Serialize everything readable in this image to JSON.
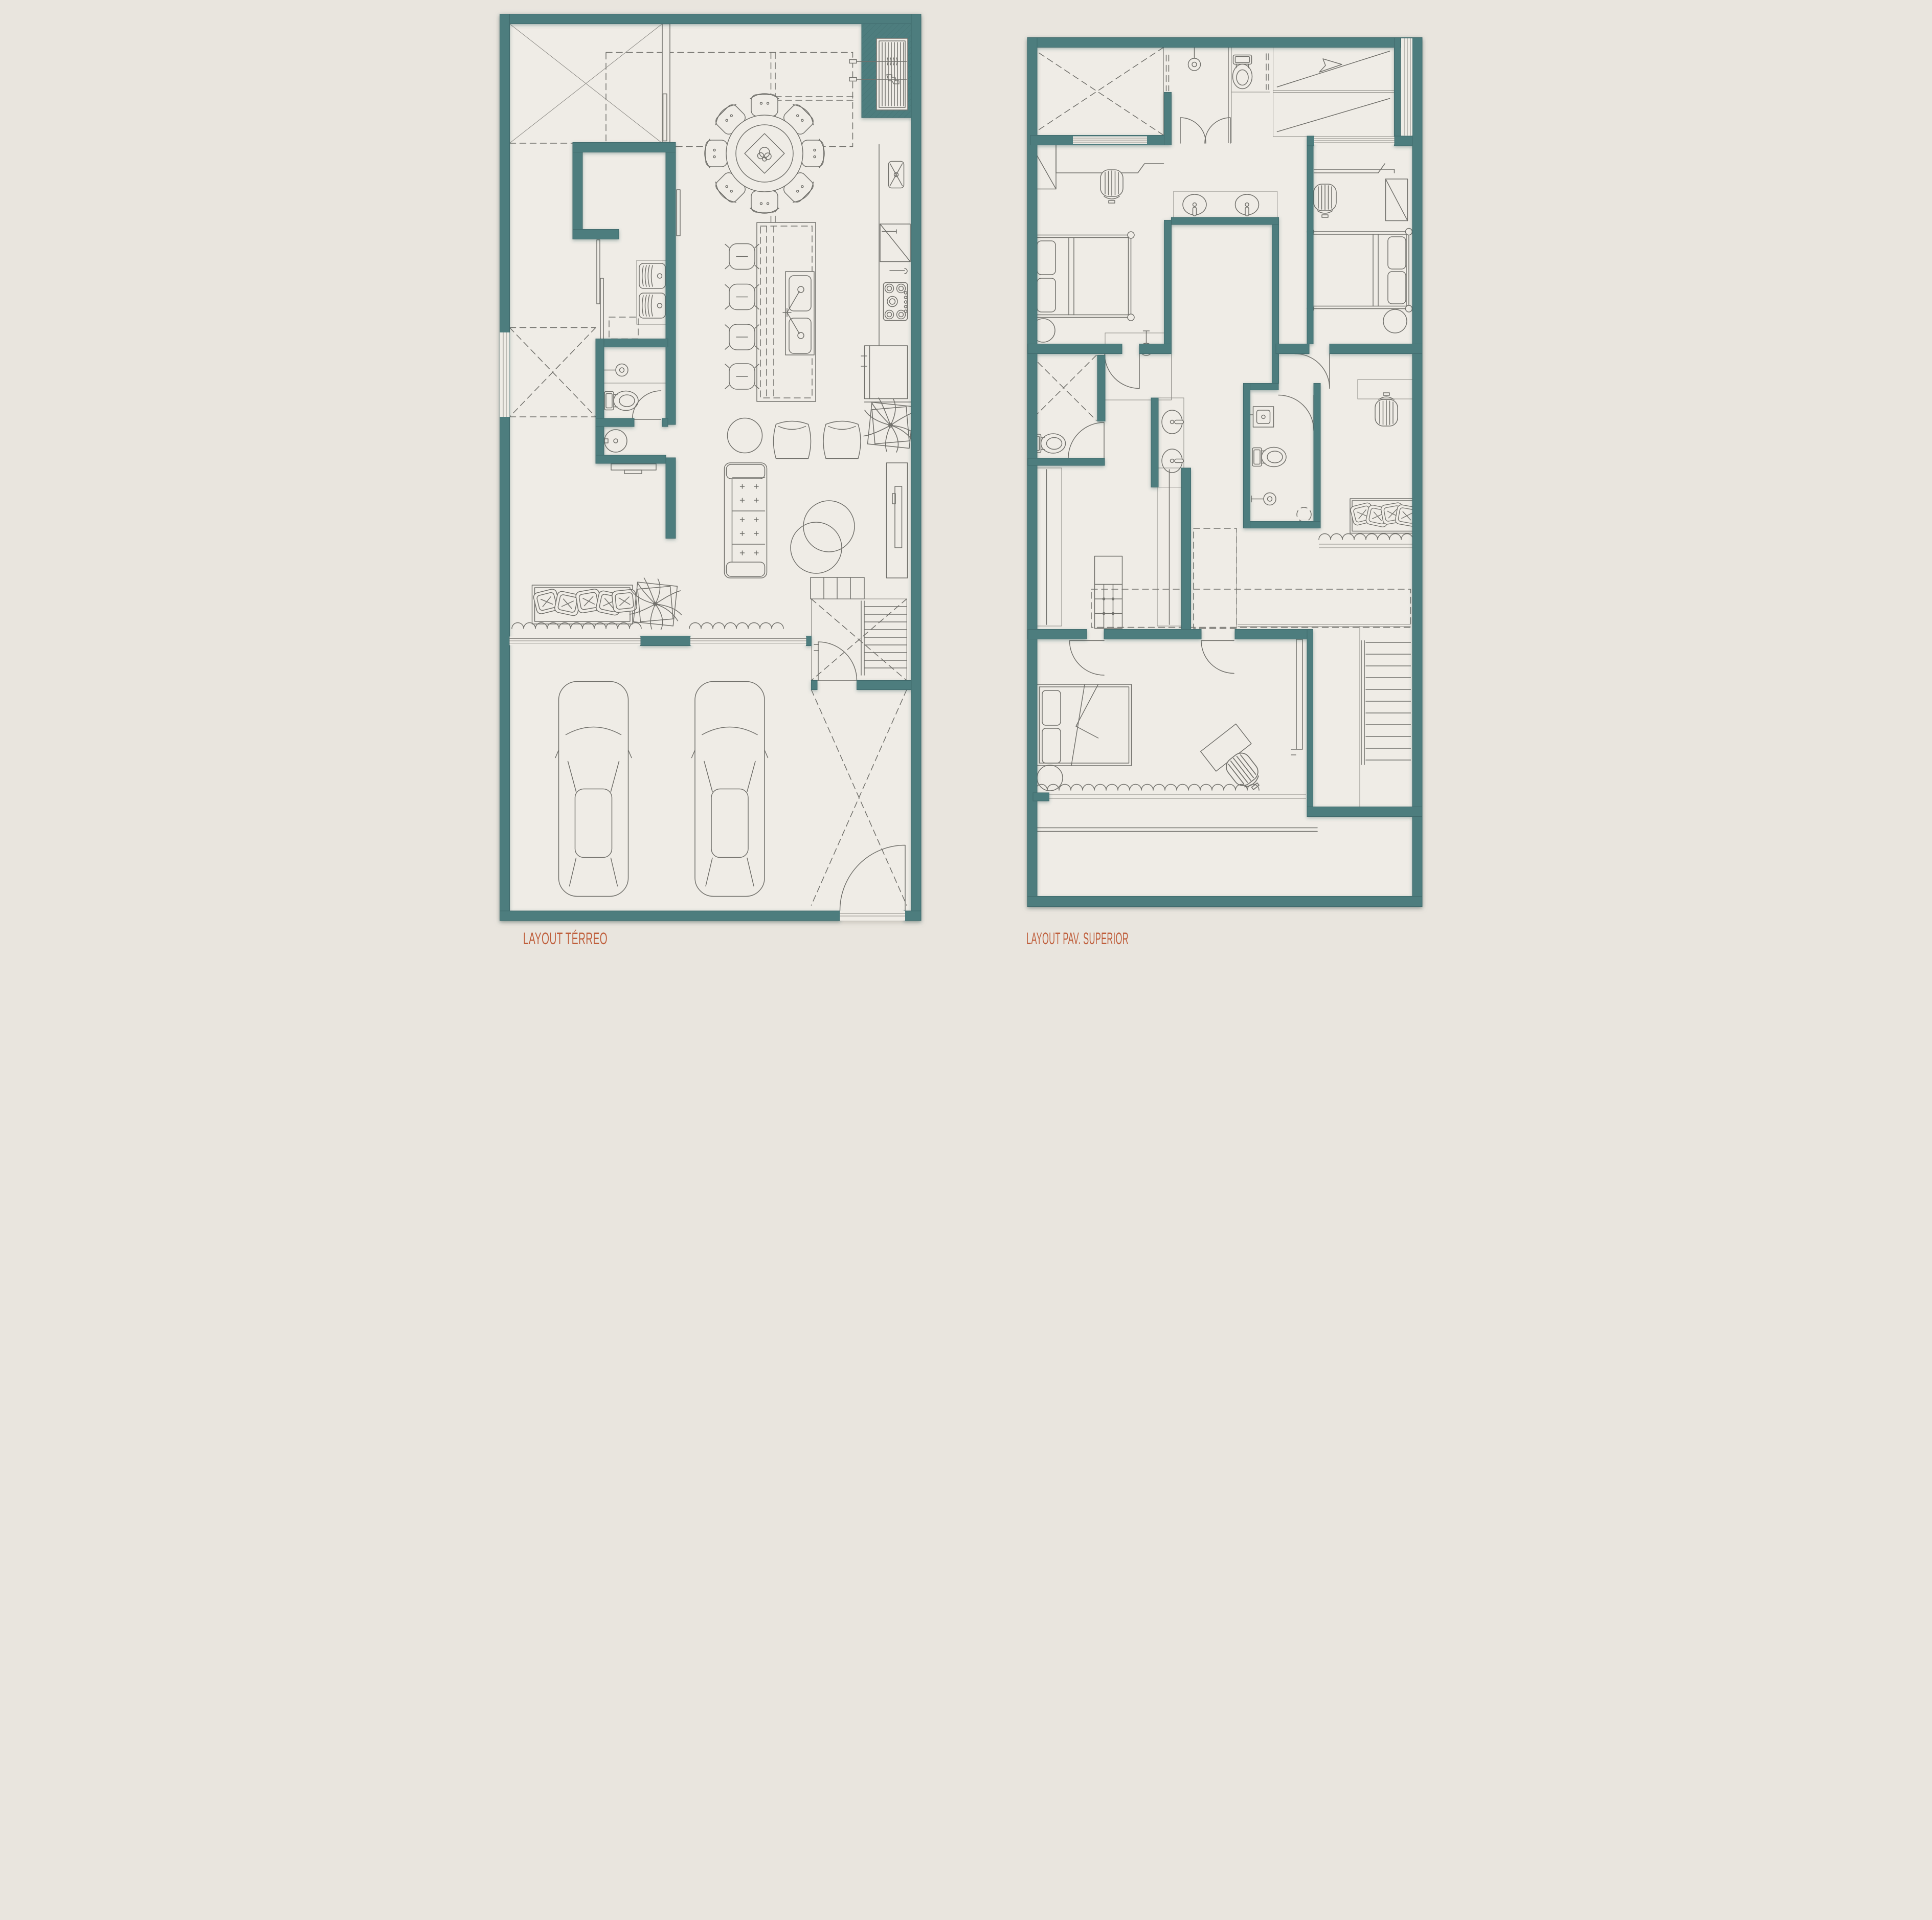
{
  "sheet": {
    "type": "architectural-floor-plan",
    "background_color": "#e9e5de",
    "floor_color": "#efece6",
    "wall_color": "#4e7d7e",
    "line_color": "#71706b",
    "label_color": "#bf5e3b"
  },
  "plans": [
    {
      "id": "terreo",
      "label": "LAYOUT TÉRREO",
      "rooms": [
        "void-terrace",
        "dining",
        "barbecue-niche",
        "kitchen",
        "laundry",
        "pantry",
        "shower-room",
        "powder-room",
        "side-patio",
        "living",
        "stairs",
        "garage"
      ],
      "furniture": [
        "round-dining-table-8-chairs",
        "kitchen-island-4-stools",
        "double-sink",
        "cooktop",
        "refrigerator",
        "laundry-tubs",
        "toilet",
        "round-washbasin",
        "shower-head",
        "sofa",
        "two-armchairs",
        "round-side-table",
        "two-coffee-tables",
        "tv-panel",
        "plants",
        "window-bench-pillows",
        "two-cars",
        "staircase",
        "entry-doors"
      ]
    },
    {
      "id": "pav-superior",
      "label": "LAYOUT PAV. SUPERIOR",
      "rooms": [
        "void",
        "shower-bath",
        "wc",
        "roof-slope",
        "bedroom-1",
        "bedroom-2",
        "shared-vanity",
        "hall",
        "side-patio",
        "wc-2",
        "master-bathroom",
        "reading-corner",
        "walk-in-closet",
        "master-bedroom",
        "balcony",
        "stairs"
      ],
      "furniture": [
        "two-single-beds",
        "two-desks-with-chairs",
        "double-vanity-sinks",
        "toilets",
        "shower-heads",
        "hanging-racks",
        "island-dresser",
        "master-bed",
        "desk-chair-set",
        "bench-pillows",
        "staircase"
      ]
    }
  ]
}
